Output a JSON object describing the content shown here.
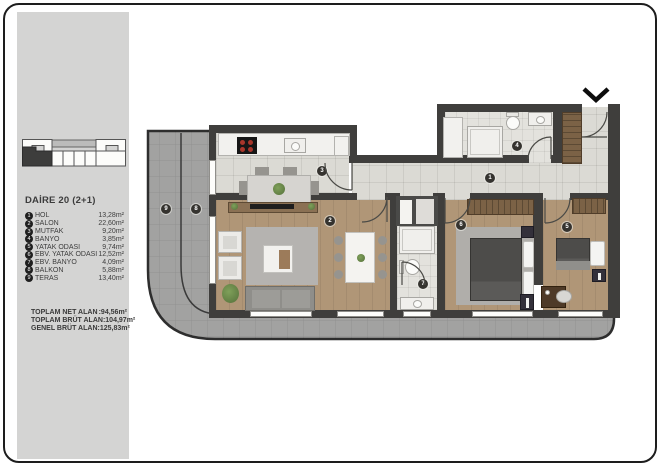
{
  "sidebar": {
    "title": "DAİRE 20 (2+1)",
    "rooms": [
      {
        "num": "1",
        "name": "HOL",
        "area": "13,28m²"
      },
      {
        "num": "2",
        "name": "SALON",
        "area": "22,60m²"
      },
      {
        "num": "3",
        "name": "MUTFAK",
        "area": "9,20m²"
      },
      {
        "num": "4",
        "name": "BANYO",
        "area": "3,85m²"
      },
      {
        "num": "5",
        "name": "YATAK ODASI",
        "area": "9,74m²"
      },
      {
        "num": "6",
        "name": "EBV. YATAK ODASI",
        "area": "12,52m²"
      },
      {
        "num": "7",
        "name": "EBV. BANYO",
        "area": "4,09m²"
      },
      {
        "num": "8",
        "name": "BALKON",
        "area": "5,88m²"
      },
      {
        "num": "9",
        "name": "TERAS",
        "area": "13,40m²"
      }
    ],
    "totals": [
      {
        "label": "TOPLAM NET ALAN",
        "value": ":94,56m²"
      },
      {
        "label": "TOPLAM BRÜT ALAN",
        "value": ":104,97m²"
      },
      {
        "label": "GENEL BRÜT ALAN",
        "value": ":125,83m²"
      }
    ]
  },
  "plan": {
    "badges": [
      {
        "num": "1"
      },
      {
        "num": "2"
      },
      {
        "num": "3"
      },
      {
        "num": "4"
      },
      {
        "num": "5"
      },
      {
        "num": "6"
      },
      {
        "num": "7"
      },
      {
        "num": "8"
      },
      {
        "num": "9"
      }
    ],
    "north_arrow": "chevron-down",
    "colors": {
      "wall": "#3f3e3c",
      "wood_floor": "#b09677",
      "tile_floor": "#dbdad4",
      "terrace": "#a2a2a1",
      "sidebar_bg": "#d4d4d3",
      "wardrobe": "#7b6246"
    }
  }
}
